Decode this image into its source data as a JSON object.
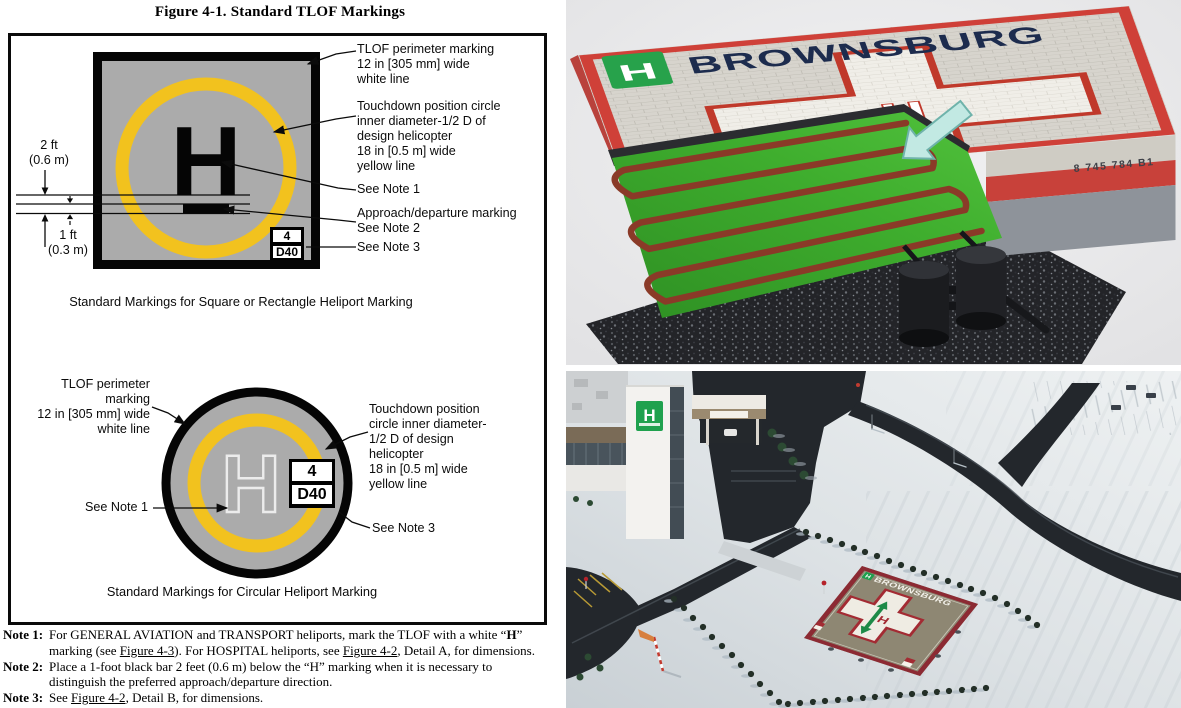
{
  "figure": {
    "title": "Figure 4-1. Standard TLOF Markings",
    "square": {
      "h": "H",
      "dim_top": "2 ft\n(0.6 m)",
      "dim_bottom": "1 ft\n(0.3 m)",
      "label_perimeter": "TLOF perimeter marking\n12 in [305 mm] wide\nwhite line",
      "label_touchdown": "Touchdown position circle\ninner diameter-1/2 D of\ndesign helicopter\n18 in [0.5 m] wide\nyellow line",
      "label_note1": "See Note 1",
      "label_approach": "Approach/departure marking\nSee Note 2",
      "label_note3": "See Note 3",
      "size_box": {
        "top": "4",
        "bottom": "D40"
      },
      "caption": "Standard Markings for Square or Rectangle Heliport Marking"
    },
    "circle": {
      "h": "H",
      "label_perimeter": "TLOF perimeter\nmarking\n12 in [305 mm] wide\nwhite line",
      "label_touchdown": "Touchdown position\ncircle inner diameter-\n1/2 D of design\nhelicopter\n18 in [0.5 m] wide\nyellow line",
      "label_note1": "See Note 1",
      "label_note3": "See Note 3",
      "size_box": {
        "top": "4",
        "bottom": "D40"
      },
      "caption": "Standard Markings for Circular Heliport Marking"
    },
    "notes": [
      {
        "label": "Note 1:",
        "segments": [
          {
            "text": "For GENERAL AVIATION and TRANSPORT heliports, mark the TLOF with a white “"
          },
          {
            "text": "H",
            "bold": true
          },
          {
            "text": "” marking (see "
          },
          {
            "text": "Figure 4-3",
            "underline": true
          },
          {
            "text": "). For HOSPITAL heliports, see "
          },
          {
            "text": "Figure 4-2",
            "underline": true
          },
          {
            "text": ", Detail A, for dimensions."
          }
        ]
      },
      {
        "label": "Note 2:",
        "segments": [
          {
            "text": "Place a 1-foot black bar 2 feet (0.6 m) below the “H” marking when it is necessary to distinguish the preferred approach/departure direction."
          }
        ]
      },
      {
        "label": "Note 3:",
        "segments": [
          {
            "text": "See "
          },
          {
            "text": "Figure 4-2",
            "underline": true
          },
          {
            "text": ", Detail B, for dimensions."
          }
        ]
      }
    ],
    "colors": {
      "pad_gray": "#ABABAB",
      "circle_yellow": "#F2C21E"
    }
  },
  "render": {
    "brand": "BROWNSBURG",
    "logo_letter": "H",
    "cross_letter": "H",
    "edge_text": "8 745 784 B1",
    "colors": {
      "deck_red": "#CF4038",
      "mat_green": "#3FAE2E",
      "coil_red": "#8A3A28",
      "brand_navy": "#1D2C4E"
    }
  },
  "photo": {
    "pad_brand": "BROWNSBURG",
    "pad_letter": "H",
    "building_sign_letter": "H",
    "colors": {
      "pad_tan": "#8E8773",
      "pad_border": "#8C2A33",
      "cross_red": "#A32B33",
      "arrow_green": "#1D8A47",
      "sign_green": "#1FA14E"
    }
  }
}
